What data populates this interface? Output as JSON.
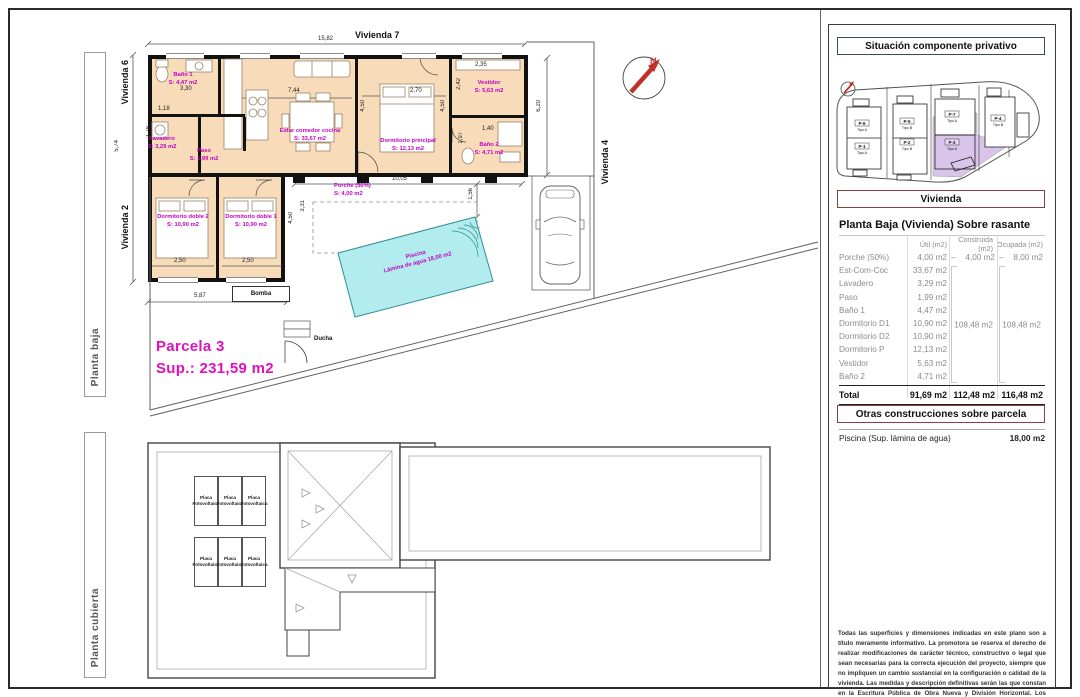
{
  "plan": {
    "frame_labels": {
      "top_view": "Planta baja",
      "bottom_view": "Planta cubierta"
    },
    "neighbors": {
      "top": "Vivienda 7",
      "left_top": "Vivienda 6",
      "left_bottom": "Vivienda 2",
      "right": "Vivienda 4"
    },
    "parcela_title": "Parcela 3",
    "parcela_sup": "Sup.: 231,59 m2",
    "north_letter": "N",
    "rooms": [
      {
        "name": "Baño 1",
        "area": "S: 4,47 m2"
      },
      {
        "name": "Lavadero",
        "area": "S: 3,29 m2"
      },
      {
        "name": "Paso",
        "area": "S: 1,99 m2"
      },
      {
        "name": "Estar comedor cocina",
        "area": "S: 33,67 m2"
      },
      {
        "name": "Dormitorio principal",
        "area": "S: 12,13 m2"
      },
      {
        "name": "Vestidor",
        "area": "S: 5,63 m2"
      },
      {
        "name": "Baño 2",
        "area": "S: 4,71 m2"
      },
      {
        "name": "Dormitorio doble 2",
        "area": "S: 10,90 m2"
      },
      {
        "name": "Dormitorio doble 1",
        "area": "S: 10,90 m2"
      },
      {
        "name": "Porche (50%)",
        "area": "S: 4,00 m2"
      }
    ],
    "pool": {
      "name": "Piscina",
      "detail": "Lámina de agua 18,00 m2"
    },
    "bomba": "Bomba",
    "ducha": "Ducha",
    "dims": {
      "total_width": "15,82",
      "left_height": "5,74",
      "right_height": "6,20",
      "bano1_w": "3,30",
      "lavadero_w": "1,18",
      "lavadero_h": "2,78",
      "estar_w": "7,44",
      "dormp_w": "2,70",
      "dormp_h": "4,50",
      "dormp_h2": "4,50",
      "vestidor_w": "2,35",
      "vestidor_h": "2,42",
      "bano2_w": "1,40",
      "bano2_h": "1,97",
      "dorm2_w": "2,50",
      "dorm1_w": "2,50",
      "dorm_h": "4,50",
      "wing_w": "5,87",
      "porche_w": "10,05",
      "porche_h": "3,31",
      "pool_gap": "1,56"
    }
  },
  "roof": {
    "panel_line1": "Placa",
    "panel_line2": "Fotovoltaica"
  },
  "panel": {
    "situacion_title": "Situación componente privativo",
    "parcels": [
      {
        "id": "P-6",
        "tipo": "Tipo A"
      },
      {
        "id": "P-1",
        "tipo": "Tipo A"
      },
      {
        "id": "P-5",
        "tipo": "Tipo B"
      },
      {
        "id": "P-2",
        "tipo": "Tipo B"
      },
      {
        "id": "P-7",
        "tipo": "Tipo A"
      },
      {
        "id": "P-3",
        "tipo": "Tipo A"
      },
      {
        "id": "P-4",
        "tipo": "Tipo B"
      }
    ],
    "vivienda_title": "Vivienda",
    "table_title": "Planta Baja (Vivienda) Sobre rasante",
    "table": {
      "col_util": "Útil (m2)",
      "col_construida": "Construida (m2)",
      "col_ocupada": "Ocupada (m2)",
      "rows": [
        {
          "label": "Porche (50%)",
          "util": "4,00 m2"
        },
        {
          "label": "Est-Com-Coc",
          "util": "33,67 m2"
        },
        {
          "label": "Lavadero",
          "util": "3,29 m2"
        },
        {
          "label": "Paso",
          "util": "1,99 m2"
        },
        {
          "label": "Baño 1",
          "util": "4,47 m2"
        },
        {
          "label": "Dormitorio D1",
          "util": "10,90 m2"
        },
        {
          "label": "Dormitorio D2",
          "util": "10,90 m2"
        },
        {
          "label": "Dormitorio P",
          "util": "12,13 m2"
        },
        {
          "label": "Vestidor",
          "util": "5,63 m2"
        },
        {
          "label": "Baño 2",
          "util": "4,71 m2"
        }
      ],
      "porche_dash": "–",
      "porche_construida": "4,00 m2",
      "porche_ocupada": "8,00 m2",
      "merged_construida": "108,48 m2",
      "merged_ocupada": "108,48 m2",
      "total_label": "Total",
      "total_util": "91,69 m2",
      "total_construida": "112,48 m2",
      "total_ocupada": "116,48 m2"
    },
    "otras_title": "Otras construcciones sobre parcela",
    "piscina_label": "Piscina (Sup. lámina de agua)",
    "piscina_value": "18,00 m2",
    "disclaimer": "Todas las superficies y dimensiones indicadas en este plano son a título meramente informativo. La promotora se reserva el derecho de realizar modificaciones de carácter técnico, constructivo o legal que sean necesarias para la correcta ejecución del proyecto, siempre que no impliquen un cambio sustancial en la configuración o calidad de la vivienda. Las medidas y descripción definitivas serán las que constan en la Escritura Pública de Obra Nueva y División Horizontal. Los elementos de mobiliario y decoración son ilustrativos y no están incluidos."
  },
  "colors": {
    "accent_magenta": "#c400c4",
    "parcela_pink": "#dd10bb",
    "pool_fill": "#b2ecee",
    "highlight_purple": "#d9c4ea",
    "north_red": "#c03028"
  }
}
